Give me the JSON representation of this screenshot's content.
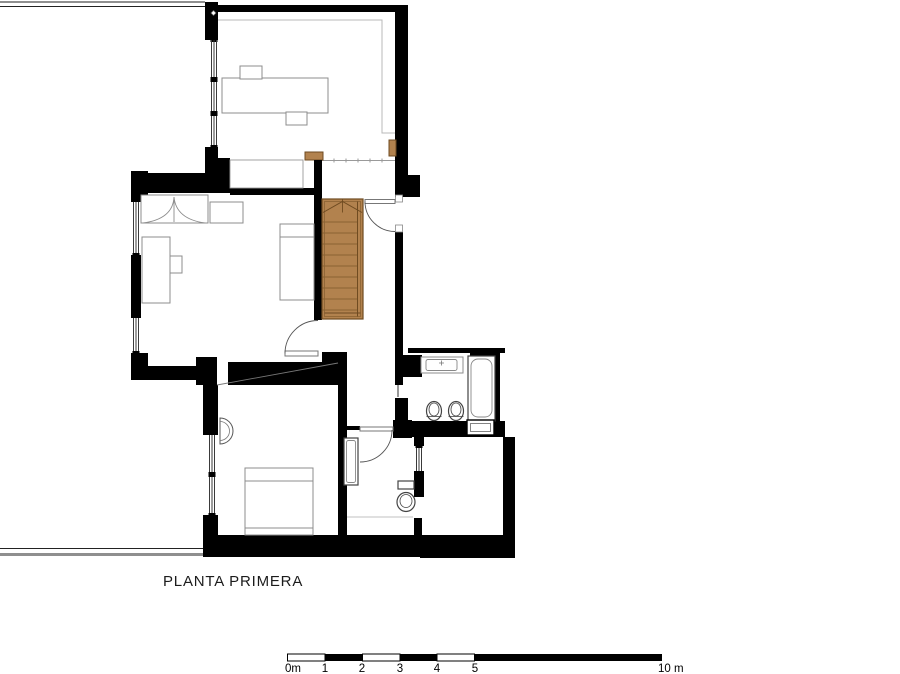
{
  "title": "PLANTA PRIMERA",
  "scalebar": {
    "labels": [
      "0m",
      "1",
      "2",
      "3",
      "4",
      "5",
      "10 m"
    ]
  },
  "colors": {
    "wall": "#000000",
    "wood_fill": "#b2824e",
    "wood_edge": "#6f4b21",
    "wood_line": "#8a6233",
    "text_color": "#1c1c1c"
  }
}
